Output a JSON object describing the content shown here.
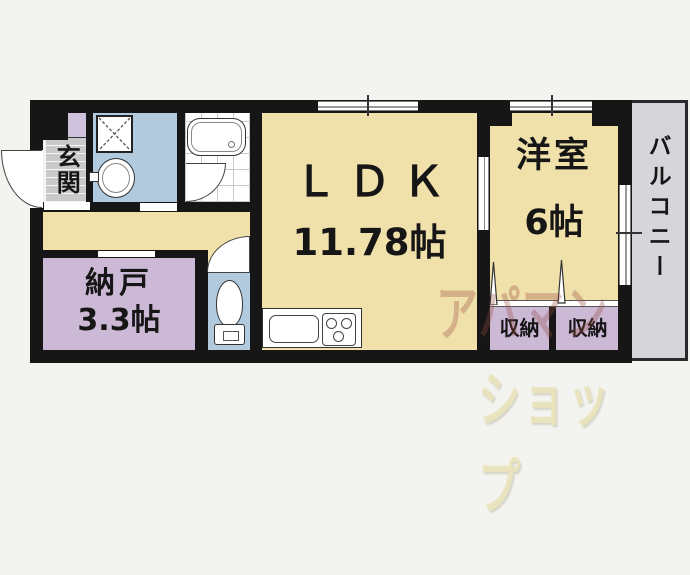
{
  "plan": {
    "type": "apartment-floorplan",
    "rooms": {
      "genkan": {
        "label": "玄関"
      },
      "nando": {
        "label": "納戸",
        "size": "3.3帖"
      },
      "ldk": {
        "label": "ＬＤＫ",
        "size": "11.78帖"
      },
      "western": {
        "label": "洋室",
        "size": "6帖"
      },
      "balcony": {
        "label": "バルコニー"
      },
      "closet1": {
        "label": "収納"
      },
      "closet2": {
        "label": "収納"
      }
    },
    "watermark": {
      "line1": "アパマン",
      "line2": "ショップ"
    },
    "colors": {
      "room_tan": "#f0e0aa",
      "room_purple": "#ccb9d6",
      "room_blue": "#b2cadd",
      "balcony_gray": "#d6d6da",
      "entry_tile_gray": "#c9c9c9",
      "wall_black": "#161616",
      "background": "#f3f3ef",
      "watermark_dark": "rgba(150,75,65,0.32)",
      "watermark_yellow": "rgba(233,228,188,0.92)"
    }
  }
}
